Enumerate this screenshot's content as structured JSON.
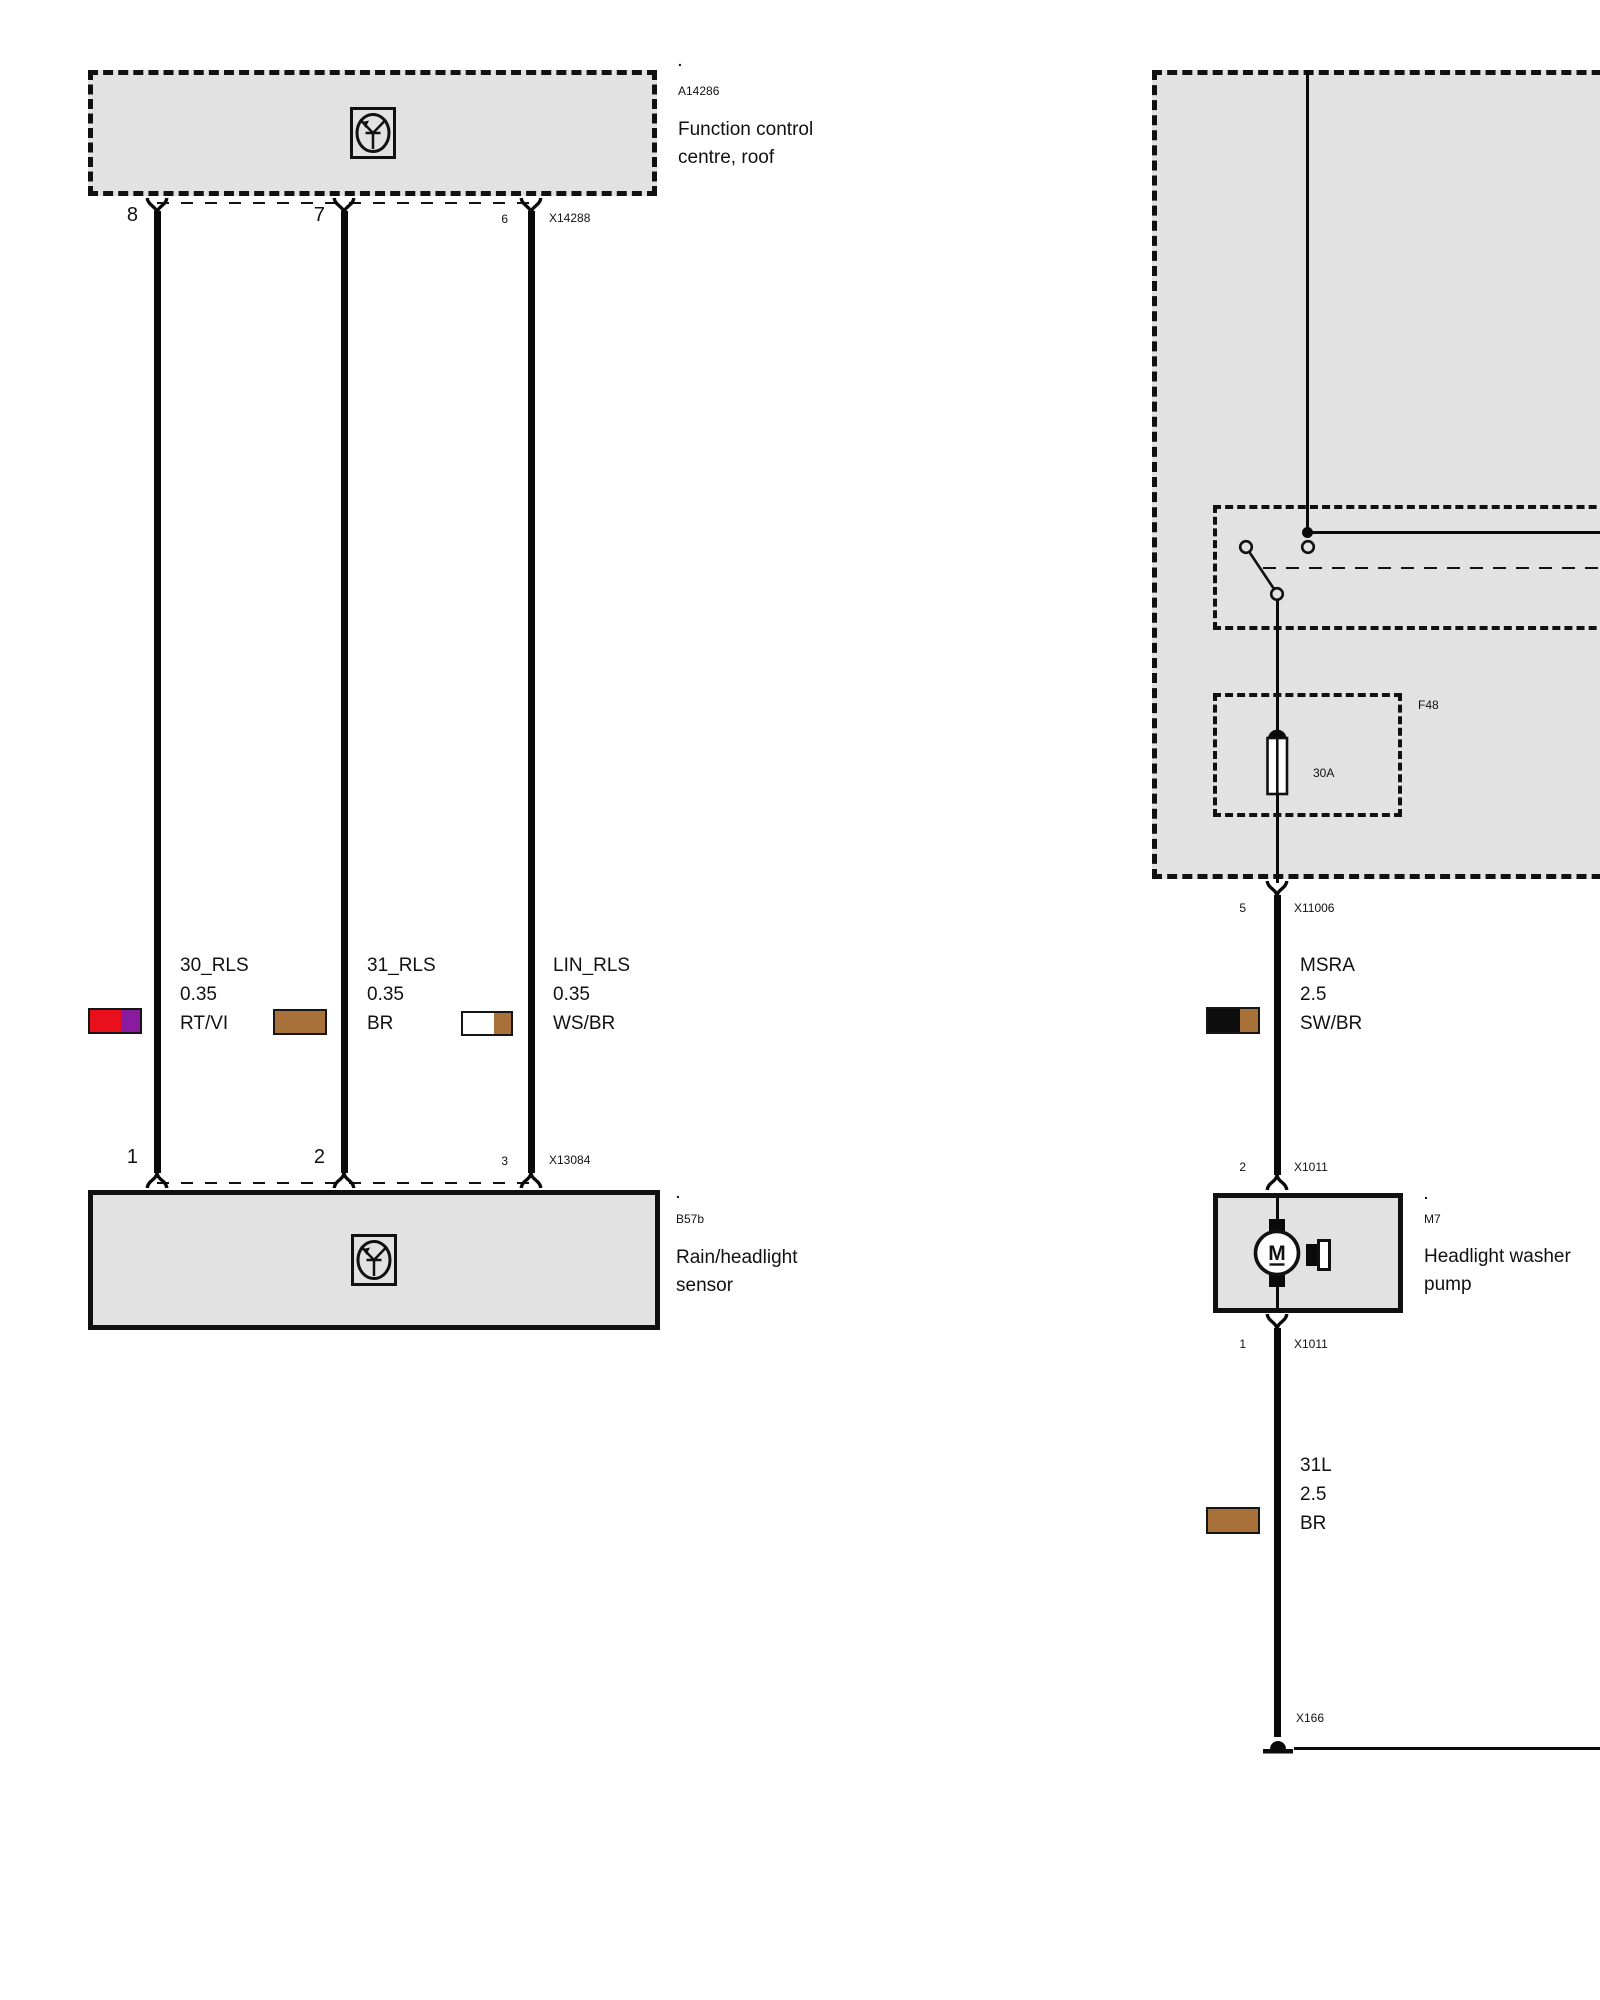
{
  "components": {
    "function_control": {
      "marker": ".",
      "id": "A14286",
      "label": "Function control centre, roof"
    },
    "rain_sensor": {
      "marker": ".",
      "id": "B57b",
      "label": "Rain/headlight sensor"
    },
    "washer_pump": {
      "marker": ".",
      "id": "M7",
      "label": "Headlight washer pump",
      "motor_letter": "M"
    }
  },
  "connectors": {
    "x14288": {
      "id": "X14288",
      "pins": {
        "p8": "8",
        "p7": "7",
        "p6": "6"
      }
    },
    "x13084": {
      "id": "X13084",
      "pins": {
        "p1": "1",
        "p2": "2",
        "p3": "3"
      }
    },
    "x11006": {
      "id": "X11006",
      "pin": "5"
    },
    "x1011_top": {
      "id": "X1011",
      "pin": "2"
    },
    "x1011_bottom": {
      "id": "X1011",
      "pin": "1"
    },
    "x166": {
      "id": "X166"
    }
  },
  "fuse": {
    "id": "F48",
    "rating": "30A"
  },
  "wires": {
    "w30rls": {
      "name": "30_RLS",
      "size": "0.35",
      "color_code": "RT/VI",
      "colors": [
        "#ea0f1c",
        "#8a1b9e"
      ]
    },
    "w31rls": {
      "name": "31_RLS",
      "size": "0.35",
      "color_code": "BR",
      "colors": [
        "#a9713a"
      ]
    },
    "wlinrls": {
      "name": "LIN_RLS",
      "size": "0.35",
      "color_code": "WS/BR",
      "colors": [
        "#ffffff",
        "#a9713a"
      ]
    },
    "wmsra": {
      "name": "MSRA",
      "size": "2.5",
      "color_code": "SW/BR",
      "colors": [
        "#0d0d0d",
        "#a9713a"
      ]
    },
    "w31l": {
      "name": "31L",
      "size": "2.5",
      "color_code": "BR",
      "colors": [
        "#a9713a"
      ]
    }
  }
}
